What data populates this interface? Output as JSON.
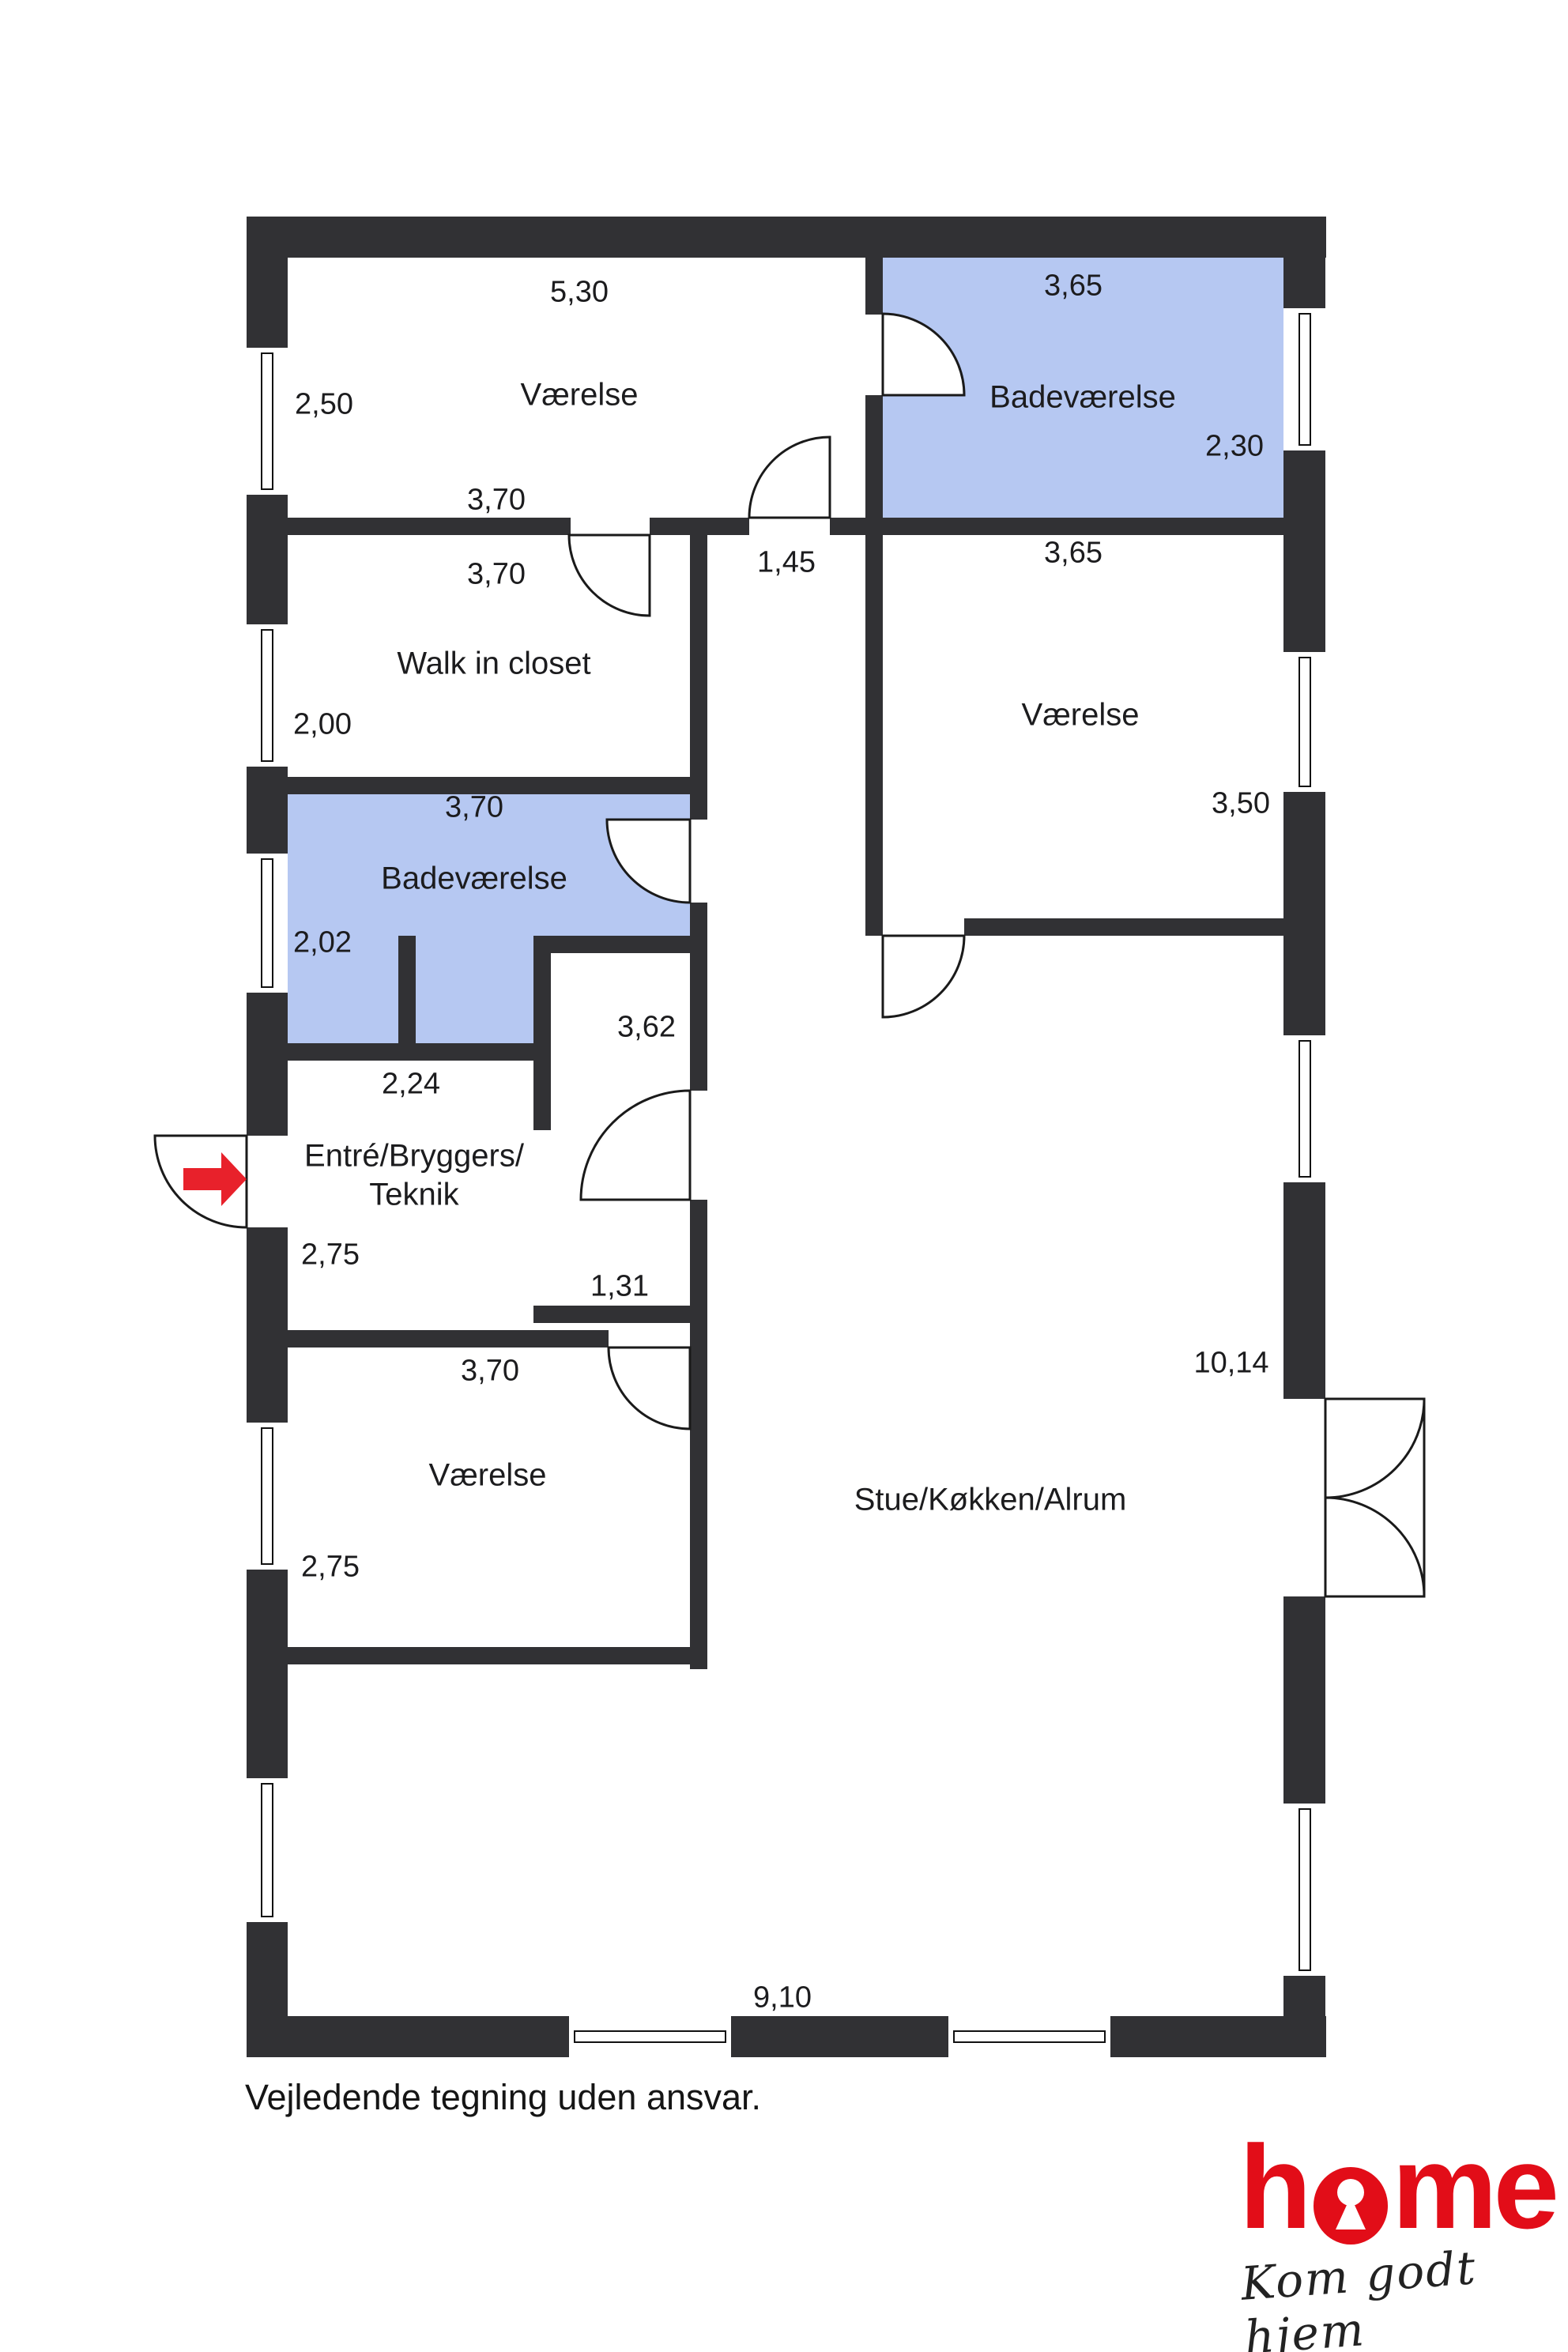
{
  "page": {
    "footer": "Vejledende tegning uden ansvar."
  },
  "branding": {
    "logo_full": "home",
    "logo_h": "h",
    "logo_me": "me",
    "tagline": "Kom godt hjem",
    "brand_red": "#e20d18"
  },
  "colors": {
    "wall": "#313134",
    "bathroom_fill": "#b6c8f2",
    "line": "#1a1a1a",
    "entrance_arrow": "#e8212b"
  },
  "rooms": {
    "bedroom_top": {
      "name": "Værelse",
      "width": "5,30",
      "depth": "2,50",
      "inner_width": "3,70"
    },
    "walk_in_closet": {
      "name": "Walk in closet",
      "width": "3,70",
      "depth": "2,00"
    },
    "hallway": {
      "width": "1,45",
      "length": "3,62"
    },
    "bathroom_top": {
      "name": "Badeværelse",
      "width": "3,65",
      "depth": "2,30"
    },
    "bedroom_right": {
      "name": "Værelse",
      "width": "3,65",
      "depth": "3,50"
    },
    "bathroom_left": {
      "name": "Badeværelse",
      "width": "3,70",
      "depth": "2,02",
      "nook_width": "2,24"
    },
    "entry": {
      "name_line1": "Entré/Bryggers/",
      "name_line2": "Teknik",
      "depth": "2,75",
      "wall_length": "1,31"
    },
    "bedroom_bottom": {
      "name": "Værelse",
      "width": "3,70",
      "depth": "2,75"
    },
    "living": {
      "name": "Stue/Køkken/Alrum",
      "length": "10,14",
      "width": "9,10"
    }
  }
}
